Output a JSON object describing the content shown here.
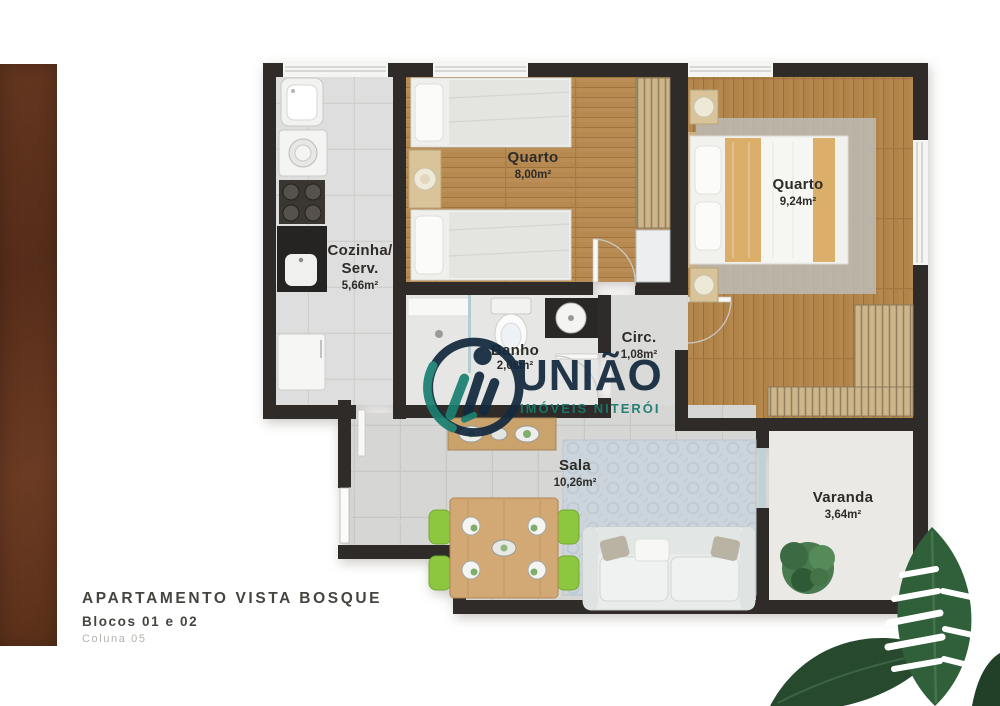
{
  "title_block": {
    "title": "APARTAMENTO VISTA BOSQUE",
    "subtitle": "Blocos 01 e 02",
    "caption": "Coluna 05"
  },
  "watermark": {
    "brand": "UNIÃO",
    "tagline": "IMÓVEIS NITERÓI",
    "brand_color": "#14293e",
    "accent_color": "#177a6c"
  },
  "rooms": {
    "cozinha": {
      "name_line1": "Cozinha/",
      "name_line2": "Serv.",
      "area": "5,66m²"
    },
    "quarto1": {
      "name": "Quarto",
      "area": "8,00m²"
    },
    "quarto2": {
      "name": "Quarto",
      "area": "9,24m²"
    },
    "banho": {
      "name": "Banho",
      "area": "2,08m²"
    },
    "circ": {
      "name": "Circ.",
      "area": "1,08m²"
    },
    "sala": {
      "name": "Sala",
      "area": "10,26m²"
    },
    "varanda": {
      "name": "Varanda",
      "area": "3,64m²"
    }
  },
  "colors": {
    "wall": "#2e2b28",
    "wood_floor": "#b5894f",
    "tile_floor": "#dedede",
    "chair_green": "#8dc63f",
    "panel_brown": "#5f341f",
    "leaf_green": "#2f5e39"
  }
}
